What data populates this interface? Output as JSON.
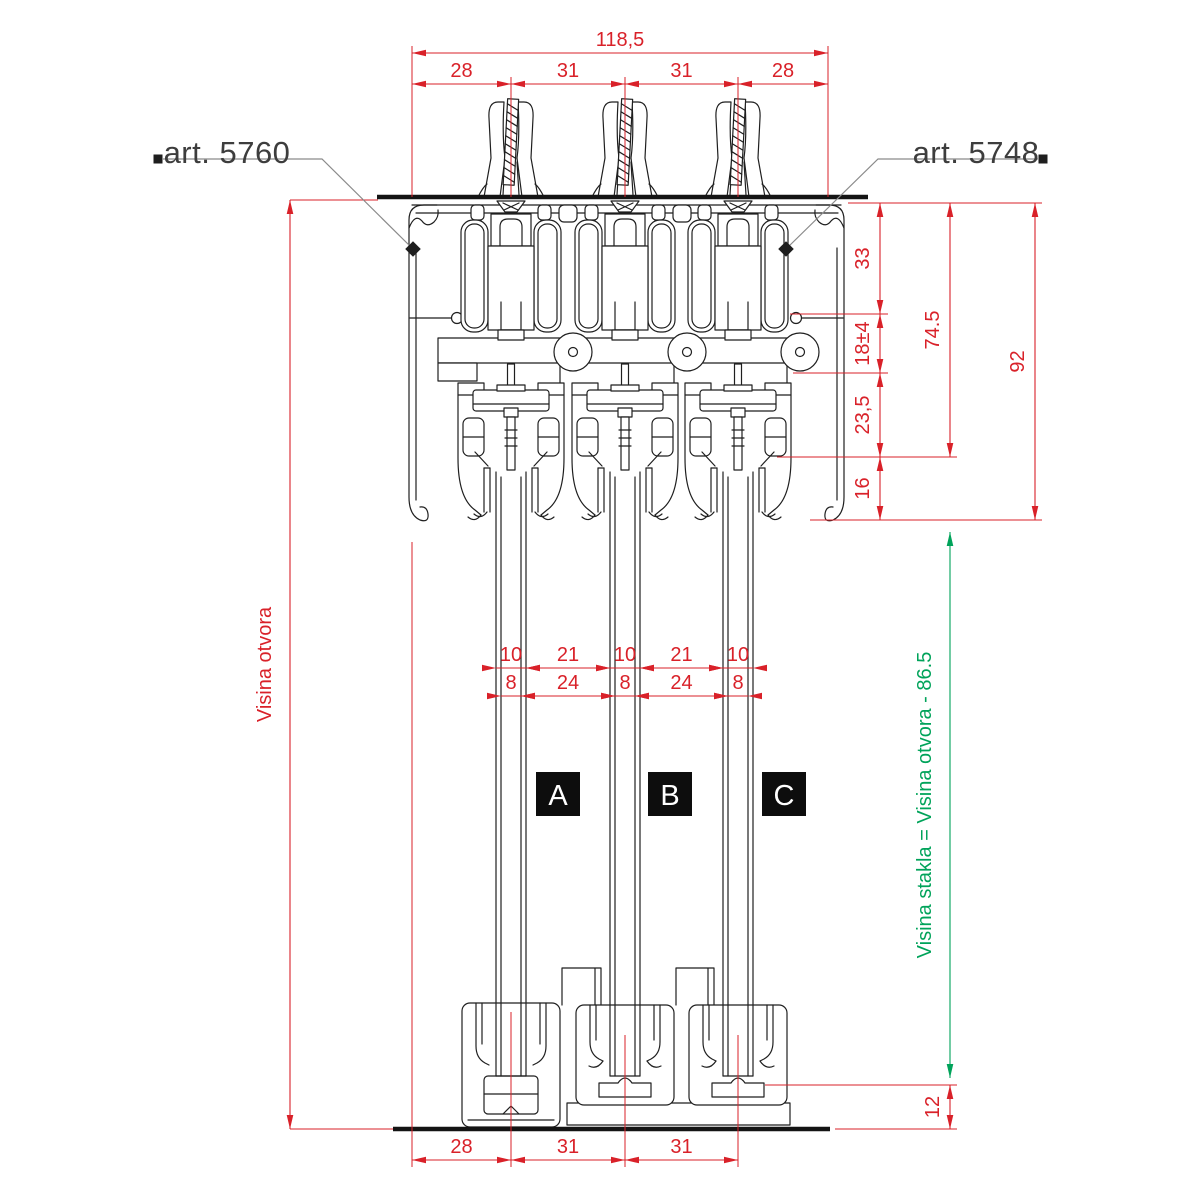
{
  "colors": {
    "dimension": "#d92129",
    "glass_dimension": "#00a35a",
    "leader": "#8a8a8a",
    "marker": "#1e1e1e",
    "label_text": "#3d3d3d"
  },
  "labels": {
    "art_left": "art. 5760",
    "art_right": "art. 5748",
    "panels": [
      "A",
      "B",
      "C"
    ]
  },
  "dimensions": {
    "horizontal": [
      {
        "label": "118,5",
        "y": 53,
        "x1": 412,
        "x2": 828
      },
      {
        "label": "28",
        "y": 84,
        "x1": 412,
        "x2": 511
      },
      {
        "label": "31",
        "y": 84,
        "x1": 511,
        "x2": 625
      },
      {
        "label": "31",
        "y": 84,
        "x1": 625,
        "x2": 738
      },
      {
        "label": "28",
        "y": 84,
        "x1": 738,
        "x2": 828
      },
      {
        "label": "10",
        "y": 668,
        "x1": 496,
        "x2": 526,
        "outside": true
      },
      {
        "label": "21",
        "y": 668,
        "x1": 526,
        "x2": 610
      },
      {
        "label": "10",
        "y": 668,
        "x1": 610,
        "x2": 640,
        "outside": true
      },
      {
        "label": "21",
        "y": 668,
        "x1": 640,
        "x2": 723
      },
      {
        "label": "10",
        "y": 668,
        "x1": 723,
        "x2": 753,
        "outside": true
      },
      {
        "label": "8",
        "y": 696,
        "x1": 501,
        "x2": 521,
        "outside": true
      },
      {
        "label": "24",
        "y": 696,
        "x1": 521,
        "x2": 615
      },
      {
        "label": "8",
        "y": 696,
        "x1": 615,
        "x2": 635,
        "outside": true
      },
      {
        "label": "24",
        "y": 696,
        "x1": 635,
        "x2": 728
      },
      {
        "label": "8",
        "y": 696,
        "x1": 728,
        "x2": 748,
        "outside": true
      },
      {
        "label": "28",
        "y": 1160,
        "x1": 412,
        "x2": 511
      },
      {
        "label": "31",
        "y": 1160,
        "x1": 511,
        "x2": 625
      },
      {
        "label": "31",
        "y": 1160,
        "x1": 625,
        "x2": 738
      }
    ],
    "vertical": [
      {
        "label": "33",
        "x": 880,
        "y1": 203,
        "y2": 314
      },
      {
        "label": "18±4",
        "x": 880,
        "y1": 314,
        "y2": 373
      },
      {
        "label": "23,5",
        "x": 880,
        "y1": 373,
        "y2": 457
      },
      {
        "label": "16",
        "x": 880,
        "y1": 457,
        "y2": 520
      },
      {
        "label": "74.5",
        "x": 950,
        "y1": 203,
        "y2": 457
      },
      {
        "label": "92",
        "x": 1035,
        "y1": 203,
        "y2": 520
      },
      {
        "label": "12",
        "x": 950,
        "y1": 1085,
        "y2": 1129
      },
      {
        "label": "Visina otvora",
        "x": 290,
        "y1": 200,
        "y2": 1129,
        "dx": -19
      },
      {
        "label": "Visina stakla = Visina otvora - 86.5",
        "x": 950,
        "y1": 532,
        "y2": 1078,
        "dx": -19,
        "color": "green"
      }
    ],
    "extension_lines": [
      {
        "x1": 412,
        "y1": 46,
        "x2": 412,
        "y2": 197
      },
      {
        "x1": 828,
        "y1": 46,
        "x2": 828,
        "y2": 197
      },
      {
        "x1": 511,
        "y1": 77,
        "x2": 511,
        "y2": 197
      },
      {
        "x1": 625,
        "y1": 77,
        "x2": 625,
        "y2": 197
      },
      {
        "x1": 738,
        "y1": 77,
        "x2": 738,
        "y2": 197
      },
      {
        "x1": 290,
        "y1": 200,
        "x2": 378,
        "y2": 200
      },
      {
        "x1": 848,
        "y1": 203,
        "x2": 1042,
        "y2": 203
      },
      {
        "x1": 790,
        "y1": 314,
        "x2": 888,
        "y2": 314
      },
      {
        "x1": 793,
        "y1": 373,
        "x2": 888,
        "y2": 373
      },
      {
        "x1": 777,
        "y1": 457,
        "x2": 957,
        "y2": 457
      },
      {
        "x1": 810,
        "y1": 520,
        "x2": 1042,
        "y2": 520
      },
      {
        "x1": 765,
        "y1": 1085,
        "x2": 957,
        "y2": 1085
      },
      {
        "x1": 835,
        "y1": 1129,
        "x2": 957,
        "y2": 1129
      },
      {
        "x1": 290,
        "y1": 1129,
        "x2": 393,
        "y2": 1129
      },
      {
        "x1": 412,
        "y1": 542,
        "x2": 412,
        "y2": 1167
      },
      {
        "x1": 511,
        "y1": 1012,
        "x2": 511,
        "y2": 1167
      },
      {
        "x1": 625,
        "y1": 1035,
        "x2": 625,
        "y2": 1167
      },
      {
        "x1": 738,
        "y1": 1035,
        "x2": 738,
        "y2": 1167
      }
    ],
    "leaders": [
      {
        "key": "art_left",
        "square": [
          158,
          159
        ],
        "points": [
          [
            163,
            159
          ],
          [
            322,
            159
          ],
          [
            413,
            249
          ]
        ],
        "diamond": [
          413,
          249
        ]
      },
      {
        "key": "art_right",
        "square": [
          1043,
          159
        ],
        "points": [
          [
            1038,
            159
          ],
          [
            878,
            159
          ],
          [
            786,
            249
          ]
        ],
        "diamond": [
          786,
          249
        ]
      }
    ]
  }
}
